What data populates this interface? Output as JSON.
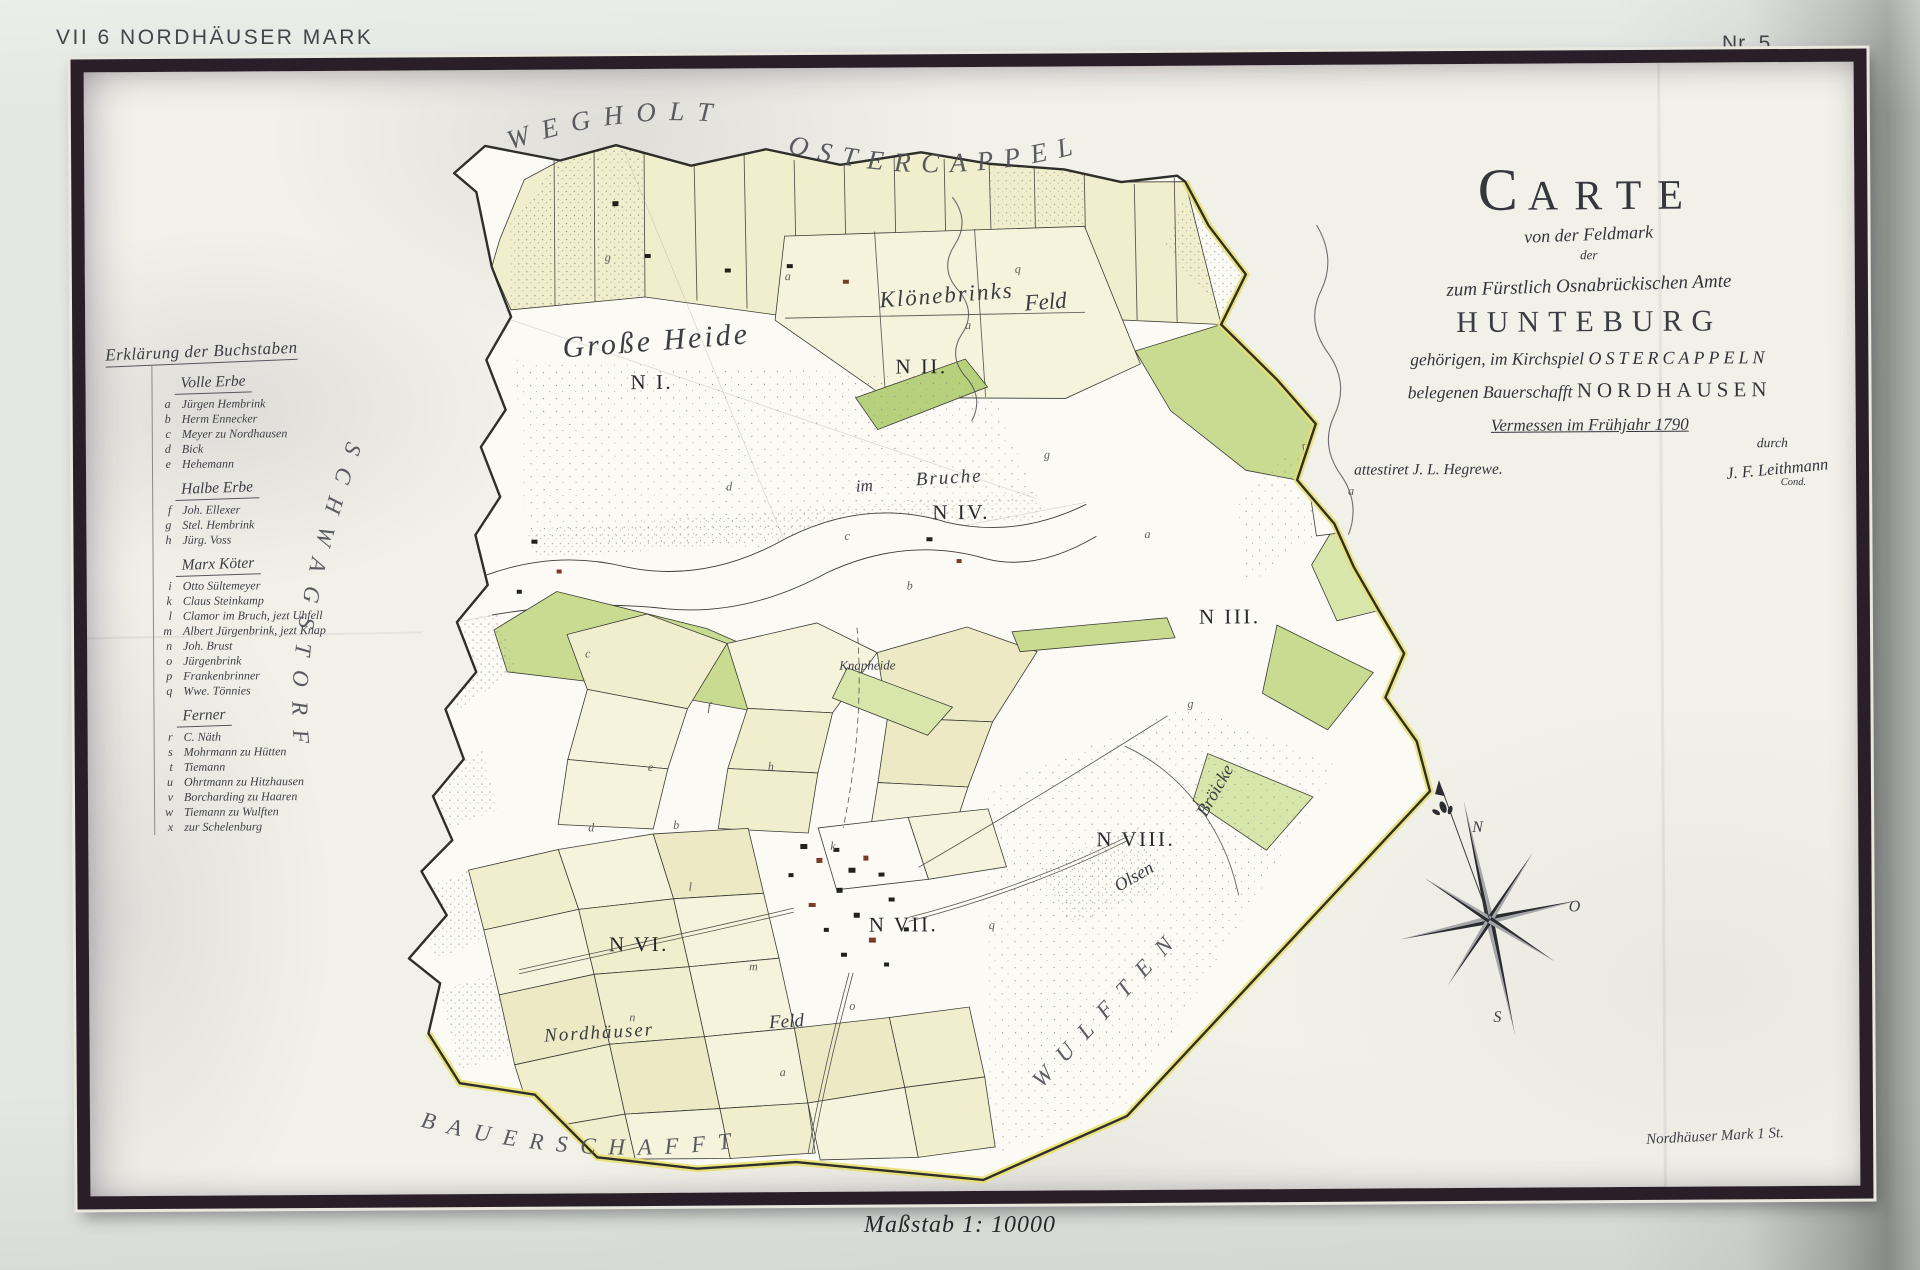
{
  "page": {
    "header_left": "VII 6 NORDHÄUSER MARK",
    "header_right": "Nr. 5",
    "caption_bottom": "Maßstab 1: 10000"
  },
  "palette": {
    "paper": "#f2f1e9",
    "ink": "#33363b",
    "parcel_yellow": "#f1eecd",
    "parcel_yellow_light": "#f6f3dd",
    "parcel_yellow_deep": "#ece9c4",
    "meadow_green": "#c9db90",
    "meadow_green_light": "#d8e5ab",
    "meadow_green_bright": "#b7d07c",
    "boundary_yellow": "#e7df6d",
    "building_red": "#7d3a28"
  },
  "map": {
    "title_block": {
      "title": "Carte",
      "sub1": "von der Feldmark",
      "sub2": "der",
      "amt_line": "zum Fürstlich Osnabrückischen Amte",
      "amt_name": "HUNTEBURG",
      "parish_pre": "gehörigen, im Kirchspiel",
      "parish_name": "OSTERCAPPELN",
      "bauerschaft_pre": "belegenen Bauerschafft",
      "bauerschaft_name": "NORDHAUSEN",
      "survey_line": "Vermessen im Frühjahr 1790",
      "durch": "durch",
      "attest": "attestiret J. L. Hegrewe.",
      "signature": "J. F. Leithmann",
      "signature_sub": "Cond."
    },
    "note": "Nordhäuser Mark 1 St.",
    "legend": {
      "title": "Erklärung der Buchstaben",
      "groups": [
        {
          "heading": "Volle Erbe",
          "items": [
            [
              "a",
              "Jürgen Hembrink"
            ],
            [
              "b",
              "Herm Ennecker"
            ],
            [
              "c",
              "Meyer zu Nordhausen"
            ],
            [
              "d",
              "Bick"
            ],
            [
              "e",
              "Hehemann"
            ]
          ]
        },
        {
          "heading": "Halbe Erbe",
          "items": [
            [
              "f",
              "Joh. Ellexer"
            ],
            [
              "g",
              "Stel. Hembrink"
            ],
            [
              "h",
              "Jürg. Voss"
            ]
          ]
        },
        {
          "heading": "Marx Köter",
          "items": [
            [
              "i",
              "Otto Sültemeyer"
            ],
            [
              "k",
              "Claus Steinkamp"
            ],
            [
              "l",
              "Clamor im Bruch, jezt Uhfell"
            ],
            [
              "m",
              "Albert Jürgenbrink, jezt Knap"
            ],
            [
              "n",
              "Joh. Brust"
            ],
            [
              "o",
              "Jürgenbrink"
            ],
            [
              "p",
              "Frankenbrinner"
            ],
            [
              "q",
              "Wwe. Tönnies"
            ]
          ]
        },
        {
          "heading": "Ferner",
          "items": [
            [
              "r",
              "C. Näth"
            ],
            [
              "s",
              "Mohrmann zu Hütten"
            ],
            [
              "t",
              "Tiemann"
            ],
            [
              "u",
              "Ohrtmann zu Hitzhausen"
            ],
            [
              "v",
              "Borcharding zu Haaren"
            ],
            [
              "w",
              "Tiemann zu Wulften"
            ],
            [
              "x",
              "zur Schelenburg"
            ]
          ]
        }
      ]
    },
    "labels": [
      {
        "text": "Große Heide",
        "x": 478,
        "y": 288,
        "size": 30,
        "rot": -4,
        "cls": "cursive",
        "ls": 3
      },
      {
        "text": "N I.",
        "x": 545,
        "y": 320,
        "size": 21,
        "cls": "roman"
      },
      {
        "text": "Klönebrinks",
        "x": 795,
        "y": 240,
        "size": 23,
        "rot": -4,
        "cls": "cursive",
        "ls": 2
      },
      {
        "text": "Feld",
        "x": 940,
        "y": 244,
        "size": 23,
        "rot": -4,
        "cls": "cursive"
      },
      {
        "text": "N II.",
        "x": 810,
        "y": 306,
        "size": 21,
        "cls": "roman"
      },
      {
        "text": "im",
        "x": 770,
        "y": 424,
        "size": 17,
        "rot": -3,
        "cls": "cursive"
      },
      {
        "text": "Bruche",
        "x": 830,
        "y": 418,
        "size": 19,
        "rot": -3,
        "cls": "cursive",
        "ls": 2
      },
      {
        "text": "N IV.",
        "x": 846,
        "y": 452,
        "size": 21,
        "cls": "roman"
      },
      {
        "text": "N III.",
        "x": 1112,
        "y": 558,
        "size": 21,
        "cls": "roman"
      },
      {
        "text": "Knapheide",
        "x": 752,
        "y": 602,
        "size": 13,
        "cls": "cursive"
      },
      {
        "text": "N VIII.",
        "x": 1008,
        "y": 780,
        "size": 21,
        "cls": "roman"
      },
      {
        "text": "Bröicke",
        "x": 1118,
        "y": 752,
        "size": 18,
        "rot": -60,
        "cls": "cursive"
      },
      {
        "text": "Olsen",
        "x": 1030,
        "y": 826,
        "size": 18,
        "rot": -30,
        "cls": "cursive"
      },
      {
        "text": "N VI.",
        "x": 520,
        "y": 882,
        "size": 21,
        "cls": "roman"
      },
      {
        "text": "N VII.",
        "x": 780,
        "y": 864,
        "size": 21,
        "cls": "roman"
      },
      {
        "text": "Nordhäuser",
        "x": 455,
        "y": 972,
        "size": 19,
        "rot": -3,
        "cls": "cursive",
        "ls": 2
      },
      {
        "text": "Feld",
        "x": 680,
        "y": 960,
        "size": 19,
        "rot": -3,
        "cls": "cursive"
      },
      {
        "text": "N",
        "x": 1384,
        "y": 768,
        "size": 16,
        "cls": "cursive"
      },
      {
        "text": "O",
        "x": 1480,
        "y": 848,
        "size": 16,
        "cls": "cursive"
      },
      {
        "text": "S",
        "x": 1404,
        "y": 958,
        "size": 16,
        "cls": "cursive"
      }
    ],
    "curved_labels": [
      {
        "text": "WEGHOLT",
        "path": "M426,80 Q560,34 690,62",
        "ls": 13,
        "size": 27
      },
      {
        "text": "OSTERCAPPELN",
        "path": "M703,84 Q850,126 1005,84",
        "ls": 11,
        "size": 27
      },
      {
        "text": "SCHWAGSTORF",
        "path": "M262,370 Q188,570 210,700 Q225,792 252,845",
        "ls": 15,
        "size": 23
      },
      {
        "text": "BAUERSCHAFFT",
        "path": "M330,1056 Q505,1104 680,1074",
        "ls": 13,
        "size": 23
      },
      {
        "text": "WULFTEN",
        "path": "M952,1022 L1172,788",
        "ls": 15,
        "size": 23
      }
    ],
    "parcel_letters": [
      {
        "t": "a",
        "x": 700,
        "y": 212
      },
      {
        "t": "g",
        "x": 520,
        "y": 192
      },
      {
        "t": "q",
        "x": 930,
        "y": 206
      },
      {
        "t": "a",
        "x": 880,
        "y": 262
      },
      {
        "t": "d",
        "x": 640,
        "y": 422
      },
      {
        "t": "c",
        "x": 758,
        "y": 472
      },
      {
        "t": "b",
        "x": 820,
        "y": 522
      },
      {
        "t": "g",
        "x": 958,
        "y": 392
      },
      {
        "t": "a",
        "x": 1058,
        "y": 472
      },
      {
        "t": "e",
        "x": 560,
        "y": 702
      },
      {
        "t": "d",
        "x": 500,
        "y": 762
      },
      {
        "t": "f",
        "x": 620,
        "y": 642
      },
      {
        "t": "h",
        "x": 680,
        "y": 702
      },
      {
        "t": "k",
        "x": 742,
        "y": 782
      },
      {
        "t": "l",
        "x": 600,
        "y": 822
      },
      {
        "t": "m",
        "x": 660,
        "y": 902
      },
      {
        "t": "n",
        "x": 540,
        "y": 952
      },
      {
        "t": "o",
        "x": 760,
        "y": 942
      },
      {
        "t": "q",
        "x": 900,
        "y": 862
      },
      {
        "t": "g",
        "x": 1100,
        "y": 642
      },
      {
        "t": "a",
        "x": 1262,
        "y": 430
      },
      {
        "t": "c",
        "x": 498,
        "y": 588
      },
      {
        "t": "b",
        "x": 585,
        "y": 760
      },
      {
        "t": "a",
        "x": 690,
        "y": 1008
      }
    ]
  }
}
